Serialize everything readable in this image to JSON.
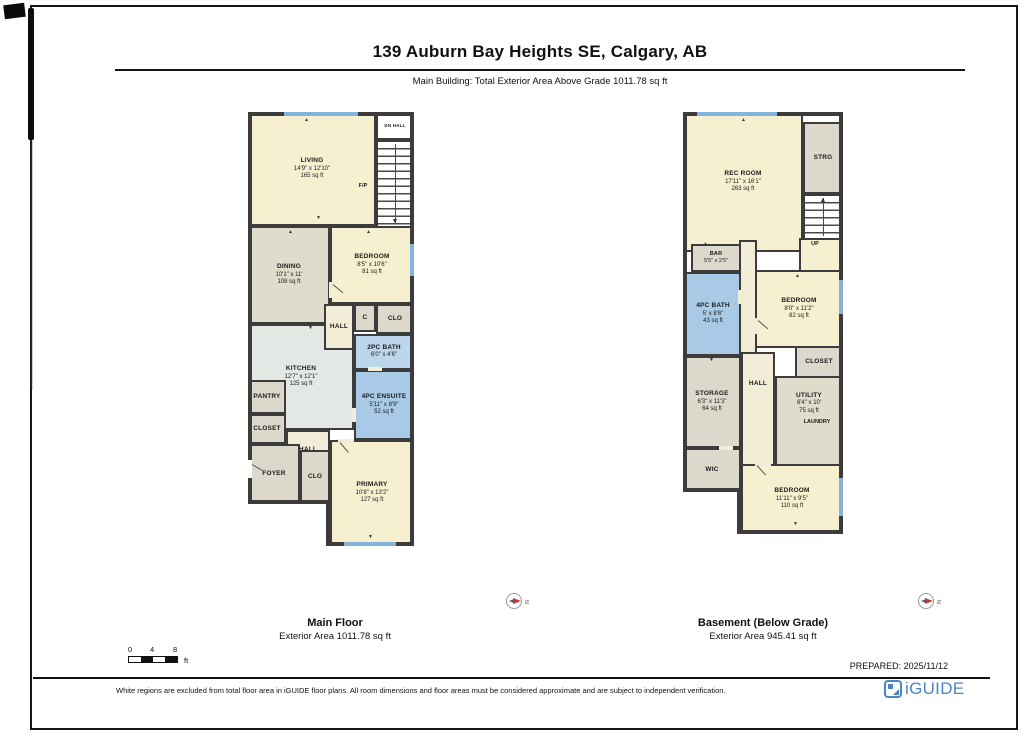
{
  "header": {
    "title": "139 Auburn Bay Heights SE, Calgary, AB",
    "subtitle": "Main Building: Total Exterior Area Above Grade 1011.78 sq ft"
  },
  "colors": {
    "brand_blue": "#4A86C8",
    "bath_blue": "#A9CAE7",
    "room_yellow": "#F6F0D0",
    "carpet_grey": "#DCD8CB",
    "window_blue": "#85B4DB",
    "wall": "#3C3C3C"
  },
  "compass": {
    "label": "N"
  },
  "scale_bar": {
    "ticks": [
      "0",
      "4",
      "8"
    ],
    "unit": "ft"
  },
  "main_floor": {
    "caption": {
      "title": "Main Floor",
      "area": "Exterior Area 1011.78 sq ft"
    },
    "rooms": {
      "living": {
        "name": "LIVING",
        "dims": "14'9\" x 12'10\"",
        "area": "165 sq ft"
      },
      "dn_hall": {
        "name": "DN HALL"
      },
      "fp": {
        "name": "F/P"
      },
      "dining": {
        "name": "DINING",
        "dims": "10'1\" x 11'",
        "area": "108 sq ft"
      },
      "bedroom": {
        "name": "BEDROOM",
        "dims": "8'5\" x 10'6\"",
        "area": "81 sq ft"
      },
      "hall_upper": {
        "name": "HALL"
      },
      "closet_c": {
        "name": "C"
      },
      "clo_upper": {
        "name": "CLO"
      },
      "bath_2pc": {
        "name": "2PC BATH",
        "dims": "6'0\" x 4'6\""
      },
      "kitchen": {
        "name": "KITCHEN",
        "dims": "12'7\" x 12'1\"",
        "area": "125 sq ft"
      },
      "ensuite": {
        "name": "4PC ENSUITE",
        "dims": "5'11\" x 8'9\"",
        "area": "52 sq ft"
      },
      "pantry": {
        "name": "PANTRY"
      },
      "closet": {
        "name": "CLOSET"
      },
      "hall_lower": {
        "name": "HALL"
      },
      "foyer": {
        "name": "FOYER"
      },
      "clo_lower": {
        "name": "CLO"
      },
      "primary": {
        "name": "PRIMARY",
        "dims": "10'8\" x 13'2\"",
        "area": "127 sq ft"
      }
    }
  },
  "basement": {
    "caption": {
      "title": "Basement (Below Grade)",
      "area": "Exterior Area 945.41 sq ft"
    },
    "rooms": {
      "rec_room": {
        "name": "REC ROOM",
        "dims": "17'11\" x 16'1\"",
        "area": "263 sq ft"
      },
      "strg": {
        "name": "STRG"
      },
      "up": {
        "name": "UP"
      },
      "bar": {
        "name": "BAR",
        "dims": "5'5\" x 2'5\""
      },
      "bath_4pc": {
        "name": "4PC BATH",
        "dims": "5' x 8'6\"",
        "area": "43 sq ft"
      },
      "bedroom_upper": {
        "name": "BEDROOM",
        "dims": "8'0\" x 11'2\"",
        "area": "82 sq ft"
      },
      "closet": {
        "name": "CLOSET"
      },
      "hall": {
        "name": "HALL"
      },
      "storage": {
        "name": "STORAGE",
        "dims": "6'3\" x 11'3\"",
        "area": "64 sq ft"
      },
      "utility": {
        "name": "UTILITY",
        "dims": "6'4\" x 10'",
        "area": "75 sq ft"
      },
      "laundry": {
        "name": "LAUNDRY"
      },
      "wic": {
        "name": "WIC"
      },
      "bedroom_lower": {
        "name": "BEDROOM",
        "dims": "11'11\" x 9'5\"",
        "area": "110 sq ft"
      }
    }
  },
  "footer": {
    "prepared": "PREPARED: 2025/11/12",
    "disclaimer": "White regions are excluded from total floor area in iGUIDE floor plans. All room dimensions and floor areas must be considered approximate and are subject to independent verification.",
    "brand": "iGUIDE"
  }
}
